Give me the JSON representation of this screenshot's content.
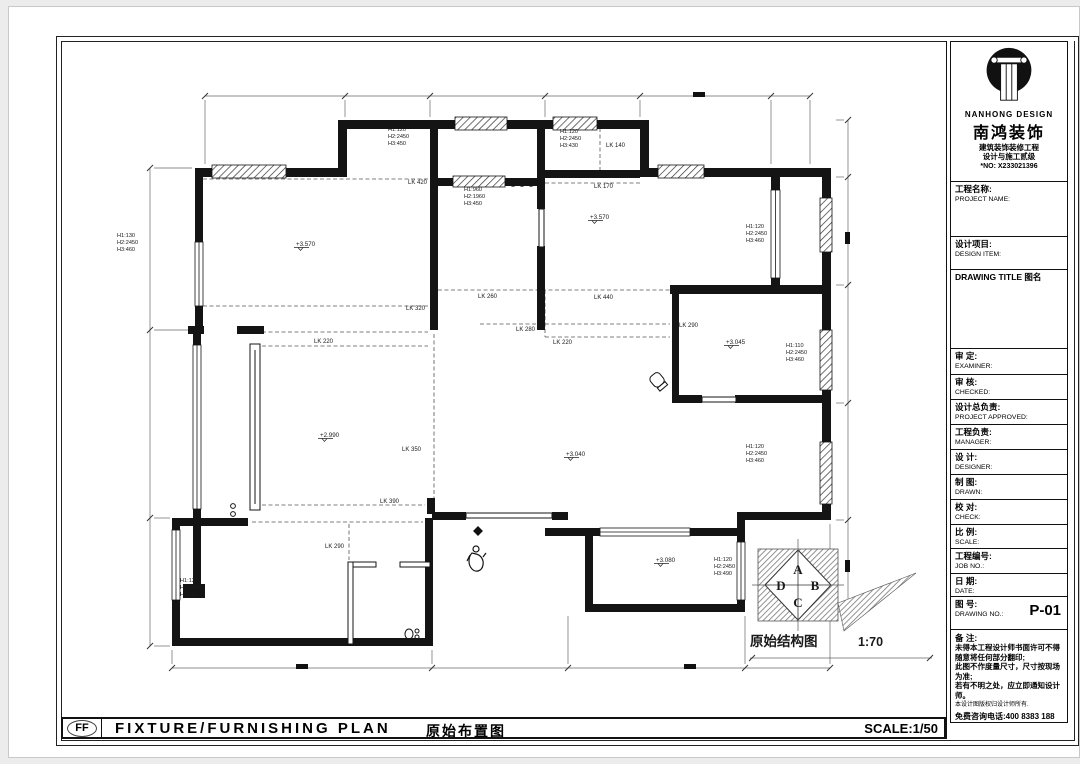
{
  "brand": {
    "logo_en": "NANHONG DESIGN",
    "logo_cn": "南鸿装饰",
    "cert_line1": "建筑装饰装修工程",
    "cert_line2": "设计与施工贰级",
    "cert_no": "*NO: X233021396"
  },
  "titleblock": {
    "rows": [
      {
        "cn": "工程名称:",
        "en": "PROJECT NAME:",
        "h": 56
      },
      {
        "cn": "设计项目:",
        "en": "DESIGN ITEM:",
        "h": 34
      },
      {
        "cn": "DRAWING TITLE 图名",
        "en": "",
        "h": 80
      },
      {
        "cn": "审  定:",
        "en": "EXAMINER:",
        "h": 27
      },
      {
        "cn": "审  核:",
        "en": "CHECKED:",
        "h": 26
      },
      {
        "cn": "设计总负责:",
        "en": "PROJECT APPROVED:",
        "h": 26
      },
      {
        "cn": "工程负责:",
        "en": "MANAGER:",
        "h": 26
      },
      {
        "cn": "设  计:",
        "en": "DESIGNER:",
        "h": 26
      },
      {
        "cn": "制  图:",
        "en": "DRAWN:",
        "h": 26
      },
      {
        "cn": "校  对:",
        "en": "CHECK:",
        "h": 26
      },
      {
        "cn": "比  例:",
        "en": "SCALE:",
        "h": 25
      },
      {
        "cn": "工程编号:",
        "en": "JOB NO.:",
        "h": 26
      },
      {
        "cn": "日  期:",
        "en": "DATE:",
        "h": 24
      },
      {
        "cn": "图  号:",
        "en": "DRAWING NO.:",
        "value": "P-01",
        "h": 34
      }
    ],
    "remarks_title": "备  注:",
    "remarks": [
      "未得本工程设计师书面许可不得",
      "随意将任何部分翻印;",
      "此图不作度量尺寸，尺寸按现场",
      "为准;",
      "若有不明之处，应立即通知设计",
      "师。"
    ],
    "remarks_small": "本设计图版权归设计师所有.",
    "hotline": "免费咨询电话:400 8383 188"
  },
  "footer": {
    "code": "FF",
    "title_en": "FIXTURE/FURNISHING PLAN",
    "title_cn": "原始布置图",
    "scale": "SCALE:1/50"
  },
  "plan": {
    "caption": "原始结构图",
    "caption_scale": "1:70",
    "compass_letters": [
      "A",
      "B",
      "C",
      "D"
    ],
    "levels": [
      {
        "t": "+3.570",
        "x": 296,
        "y": 246
      },
      {
        "t": "+3.570",
        "x": 590,
        "y": 219
      },
      {
        "t": "+2.990",
        "x": 320,
        "y": 437
      },
      {
        "t": "+3.040",
        "x": 566,
        "y": 456
      },
      {
        "t": "+3.045",
        "x": 726,
        "y": 344
      },
      {
        "t": "+3.080",
        "x": 656,
        "y": 562
      }
    ],
    "lk_labels": [
      {
        "t": "LK 420",
        "x": 408,
        "y": 184
      },
      {
        "t": "LK 140",
        "x": 606,
        "y": 147
      },
      {
        "t": "LK 170",
        "x": 594,
        "y": 188
      },
      {
        "t": "LK 320",
        "x": 406,
        "y": 310
      },
      {
        "t": "LK 220",
        "x": 314,
        "y": 343
      },
      {
        "t": "LK 260",
        "x": 478,
        "y": 298
      },
      {
        "t": "LK 440",
        "x": 594,
        "y": 299
      },
      {
        "t": "LK 280",
        "x": 516,
        "y": 331
      },
      {
        "t": "LK 220",
        "x": 553,
        "y": 344
      },
      {
        "t": "LK 290",
        "x": 679,
        "y": 327
      },
      {
        "t": "LK 350",
        "x": 402,
        "y": 451
      },
      {
        "t": "LK 390",
        "x": 380,
        "y": 503
      },
      {
        "t": "LK 290",
        "x": 325,
        "y": 548
      }
    ],
    "window_labels": [
      {
        "x": 117,
        "y": 237,
        "lines": [
          "H1:130",
          "H2:2450",
          "H3:460"
        ]
      },
      {
        "x": 388,
        "y": 131,
        "lines": [
          "H1:120",
          "H2:2450",
          "H3:450"
        ]
      },
      {
        "x": 464,
        "y": 191,
        "lines": [
          "H1:960",
          "H2:1960",
          "H3:450"
        ]
      },
      {
        "x": 560,
        "y": 133,
        "lines": [
          "H1:120",
          "H2:2450",
          "H3:430"
        ]
      },
      {
        "x": 746,
        "y": 228,
        "lines": [
          "H1:120",
          "H2:2450",
          "H3:460"
        ]
      },
      {
        "x": 786,
        "y": 347,
        "lines": [
          "H1:110",
          "H2:2450",
          "H3:460"
        ]
      },
      {
        "x": 746,
        "y": 448,
        "lines": [
          "H1:120",
          "H2:2450",
          "H3:460"
        ]
      },
      {
        "x": 714,
        "y": 561,
        "lines": [
          "H1:120",
          "H2:2450",
          "H3:490"
        ]
      },
      {
        "x": 180,
        "y": 582,
        "lines": [
          "H1:120",
          "H2:2450",
          "H3:460"
        ]
      }
    ]
  }
}
